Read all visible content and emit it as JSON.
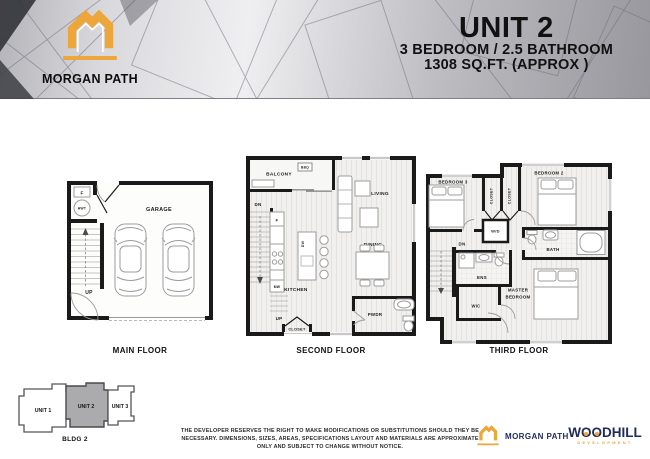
{
  "header": {
    "brand": "MORGAN PATH",
    "unit_title": "UNIT 2",
    "spec_line1": "3 BEDROOM / 2.5 BATHROOM",
    "spec_line2": "1308 SQ.FT. (APPROX )"
  },
  "floors": {
    "main": {
      "label": "MAIN FLOOR",
      "garage": "GARAGE",
      "furnace": "F",
      "hwt": "HWT",
      "up": "UP"
    },
    "second": {
      "label": "SECOND FLOOR",
      "balcony": "BALCONY",
      "bbq": "BBQ",
      "living": "LIVING",
      "dining": "DINING",
      "kitchen": "KITCHEN",
      "dw": "DW",
      "fridge": "F",
      "mw": "MW",
      "pwdr": "PWDR",
      "closet": "CLOSET",
      "dn": "DN",
      "up": "UP"
    },
    "third": {
      "label": "THIRD FLOOR",
      "bedroom3": "BEDROOM 3",
      "bedroom2": "BEDROOM 2",
      "closet1": "CLOSET",
      "closet2": "CLOSET",
      "wd": "W/D",
      "bath": "BATH",
      "ens": "ENS",
      "wic": "WIC",
      "master_line1": "MASTER",
      "master_line2": "BEDROOM",
      "dn": "DN"
    }
  },
  "building": {
    "label": "BLDG 2",
    "unit1": "UNIT 1",
    "unit2": "UNIT 2",
    "unit3": "UNIT 3",
    "highlighted": "UNIT 2"
  },
  "disclaimer": {
    "line1": "THE DEVELOPER RESERVES THE RIGHT TO MAKE MODIFICATIONS OR SUBSTITUTIONS SHOULD THEY BE",
    "line2": "NECESSARY. DIMENSIONS, SIZES, AREAS, SPECIFICATIONS LAYOUT AND MATERIALS ARE APPROXIMATE",
    "line3": "ONLY AND SUBJECT TO CHANGE WITHOUT NOTICE."
  },
  "footer": {
    "brand": "MORGAN PATH",
    "woodhill_w": "W",
    "woodhill_o1": "O",
    "woodhill_o2": "O",
    "woodhill_rest": "DHILL",
    "woodhill_sub": "DEVELOPMENT"
  },
  "colors": {
    "gold": "#EDA63A",
    "navy": "#1F2B5B",
    "wall": "#1A1A1A",
    "unit_highlight": "#ABABAE"
  }
}
